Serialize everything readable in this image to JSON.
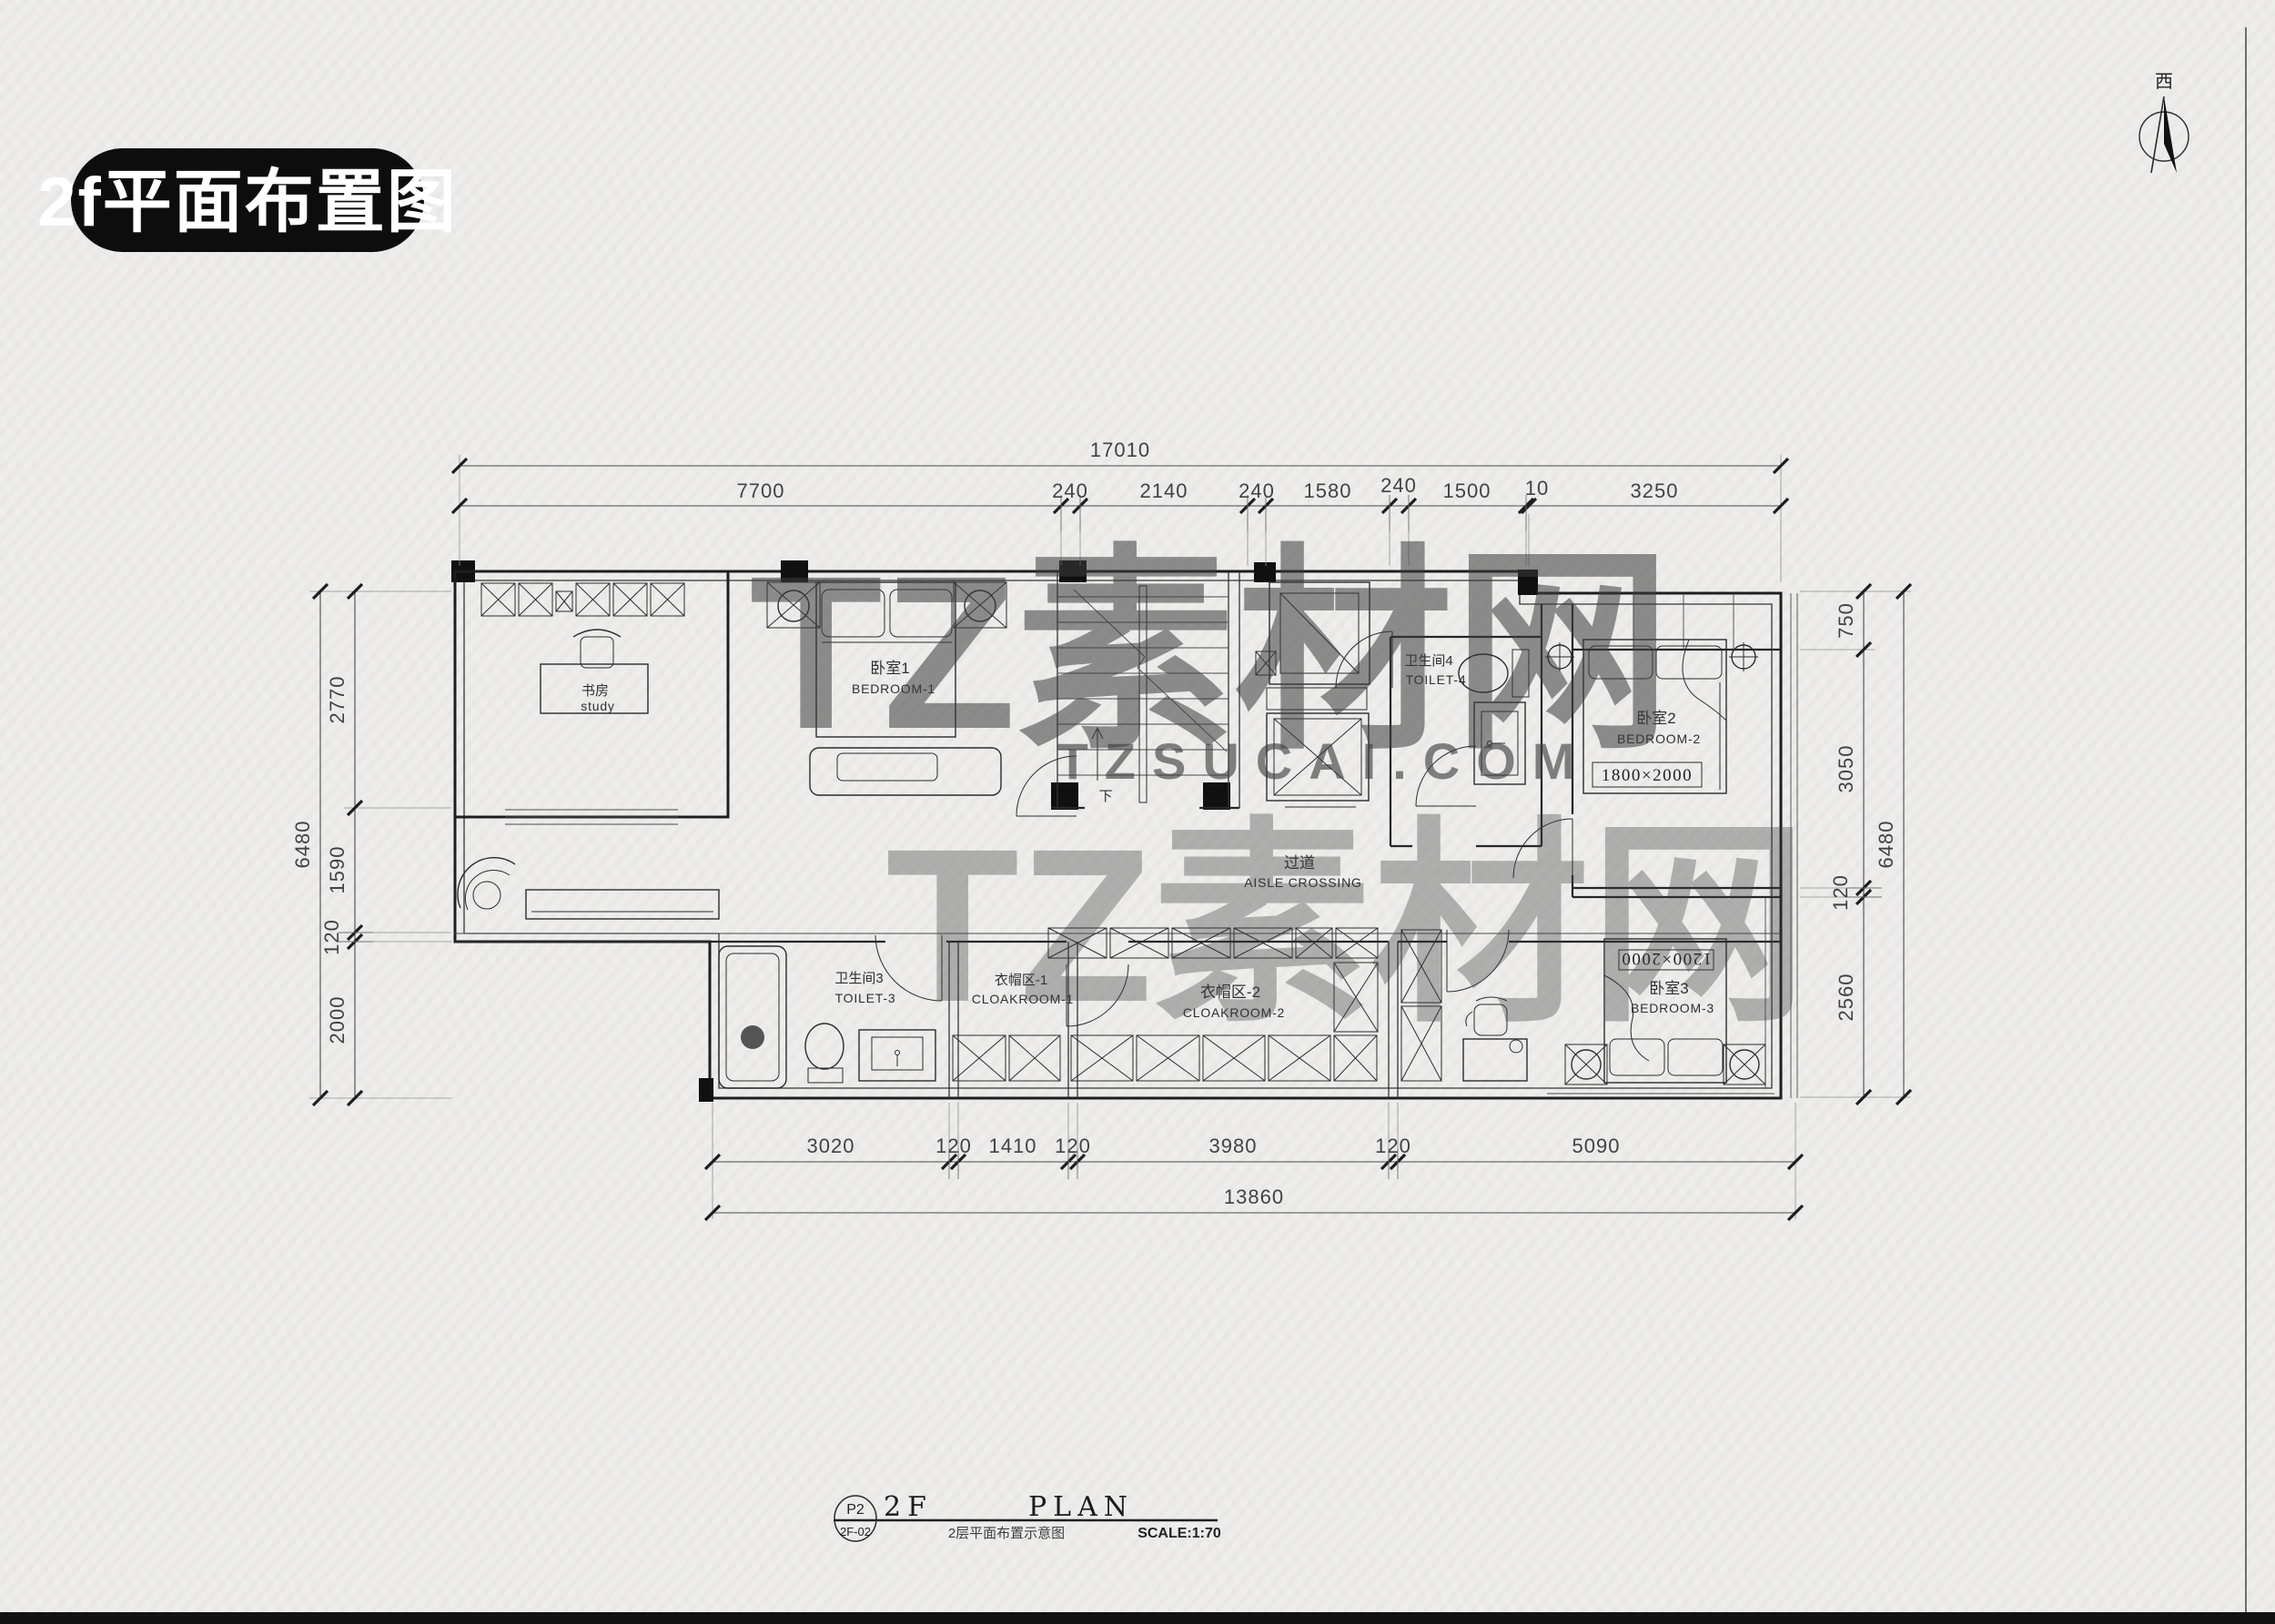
{
  "page": {
    "badge_title": "2f平面布置图",
    "compass_label": "西"
  },
  "watermark": {
    "main": "TZ素材网",
    "sub": "TZSUCAI.COM",
    "color": "#979797"
  },
  "plan": {
    "rooms": {
      "study": {
        "cn": "书房",
        "en": "study"
      },
      "bedroom1": {
        "cn": "卧室1",
        "en": "BEDROOM-1"
      },
      "toilet4": {
        "cn": "卫生间4",
        "en": "TOILET-4"
      },
      "bedroom2": {
        "cn": "卧室2",
        "en": "BEDROOM-2",
        "bed_size": "1800×2000"
      },
      "aisle": {
        "cn": "过道",
        "en": "AISLE  CROSSING"
      },
      "toilet3": {
        "cn": "卫生间3",
        "en": "TOILET-3"
      },
      "cloakroom1": {
        "cn": "衣帽区-1",
        "en": "CLOAKROOM-1"
      },
      "cloakroom2": {
        "cn": "衣帽区-2",
        "en": "CLOAKROOM-2"
      },
      "bedroom3": {
        "cn": "卧室3",
        "en": "BEDROOM-3",
        "bed_size": "1200×2000"
      }
    },
    "stairs_label": "下"
  },
  "dimensions": {
    "top": {
      "total": "17010",
      "segments": [
        "7700",
        "240",
        "2140",
        "240",
        "1580",
        "240",
        "1500",
        "10",
        "3250"
      ]
    },
    "bottom": {
      "total": "13860",
      "segments": [
        "3020",
        "120",
        "1410",
        "120",
        "3980",
        "120",
        "5090"
      ]
    },
    "left": {
      "total": "6480",
      "segments": [
        "2770",
        "1590",
        "120",
        "2000"
      ]
    },
    "right": {
      "total": "6480",
      "segments": [
        "750",
        "3050",
        "120",
        "2560"
      ]
    }
  },
  "title_block": {
    "circle_top": "P2",
    "circle_bottom": "2F-02",
    "floor": "2F",
    "plan_word": "PLAN",
    "subtitle": "2层平面布置示意图",
    "scale": "SCALE:1:70"
  },
  "colors": {
    "ink": "#1e1e1e",
    "paper": "#edecea",
    "badge_bg": "#0d0d0d",
    "badge_text": "#ffffff"
  }
}
